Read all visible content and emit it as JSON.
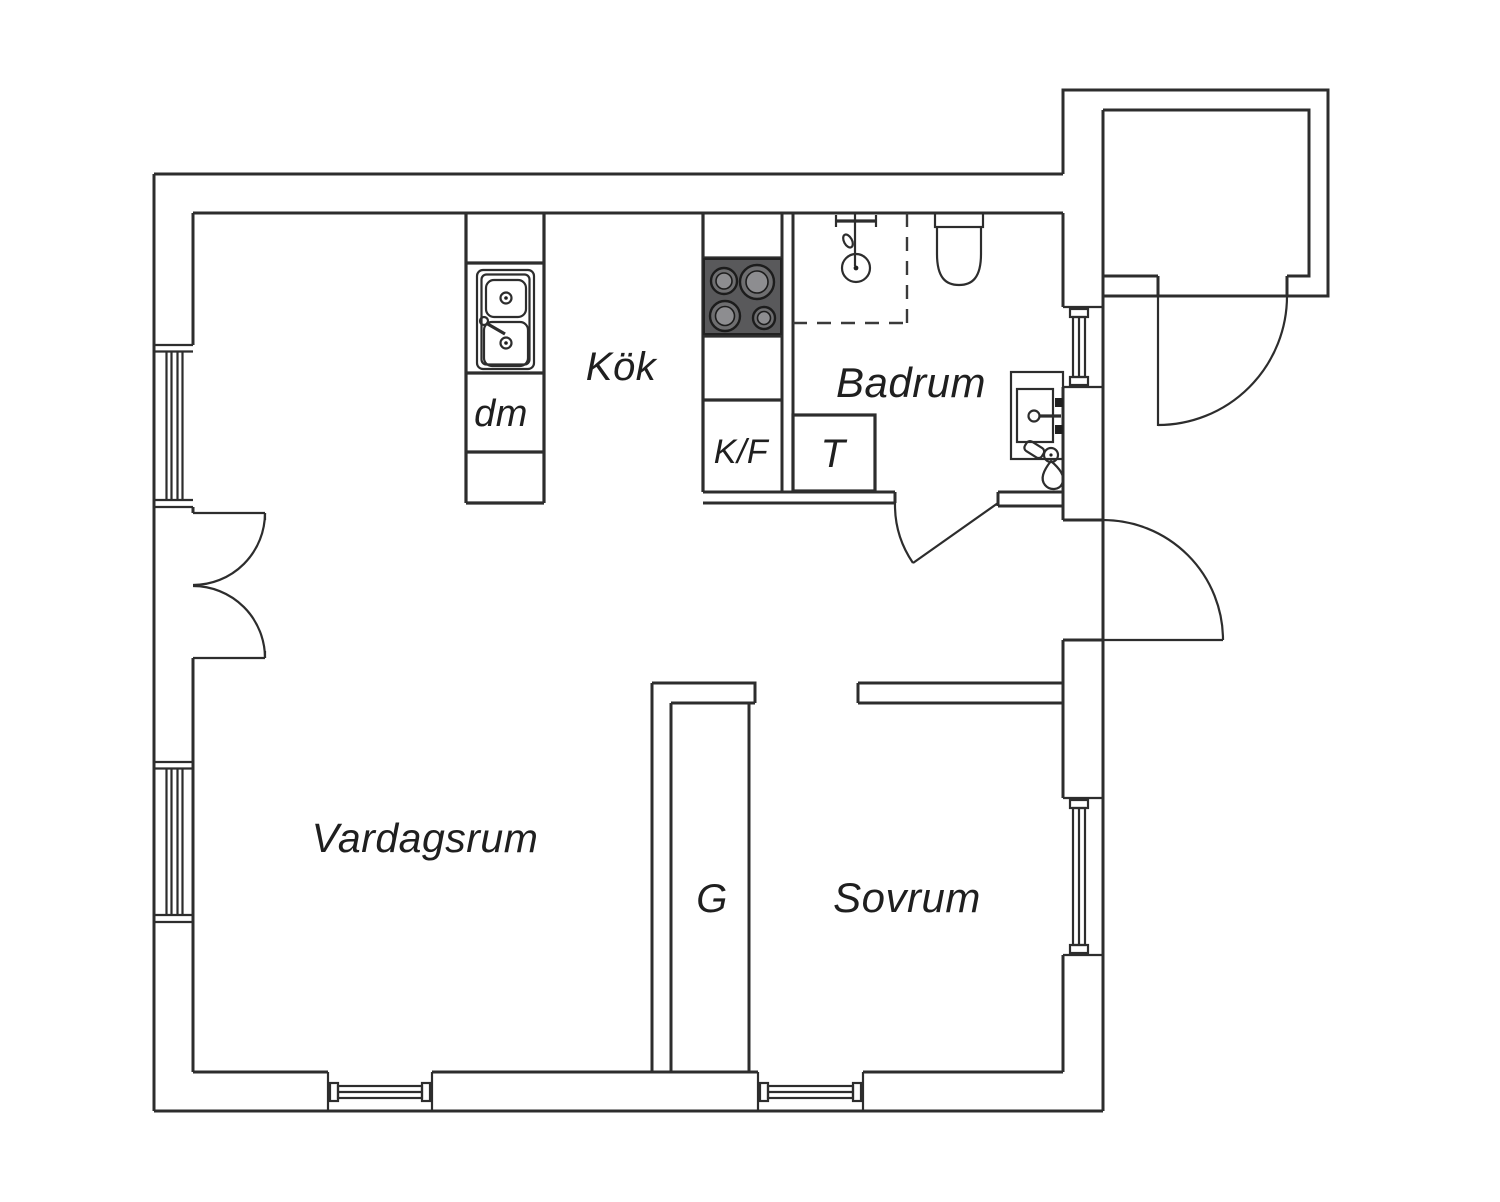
{
  "plan": {
    "type": "apartment-floor-plan",
    "language": "Swedish"
  },
  "rooms": {
    "kitchen": {
      "label": "Kök"
    },
    "bathroom": {
      "label": "Badrum"
    },
    "living_room": {
      "label": "Vardagsrum"
    },
    "bedroom": {
      "label": "Sovrum"
    }
  },
  "fixtures": {
    "dishwasher": {
      "label": "dm"
    },
    "fridge_freezer": {
      "label": "K/F"
    },
    "washer": {
      "label": "T"
    },
    "wardrobe": {
      "label": "G"
    }
  },
  "colors": {
    "background": "#ffffff",
    "wall_line": "#2d2d2d",
    "text": "#1f1f1f",
    "stove_panel": "#59595b",
    "burner_outer": "#6e6e70",
    "burner_center": "#8d8d90"
  }
}
